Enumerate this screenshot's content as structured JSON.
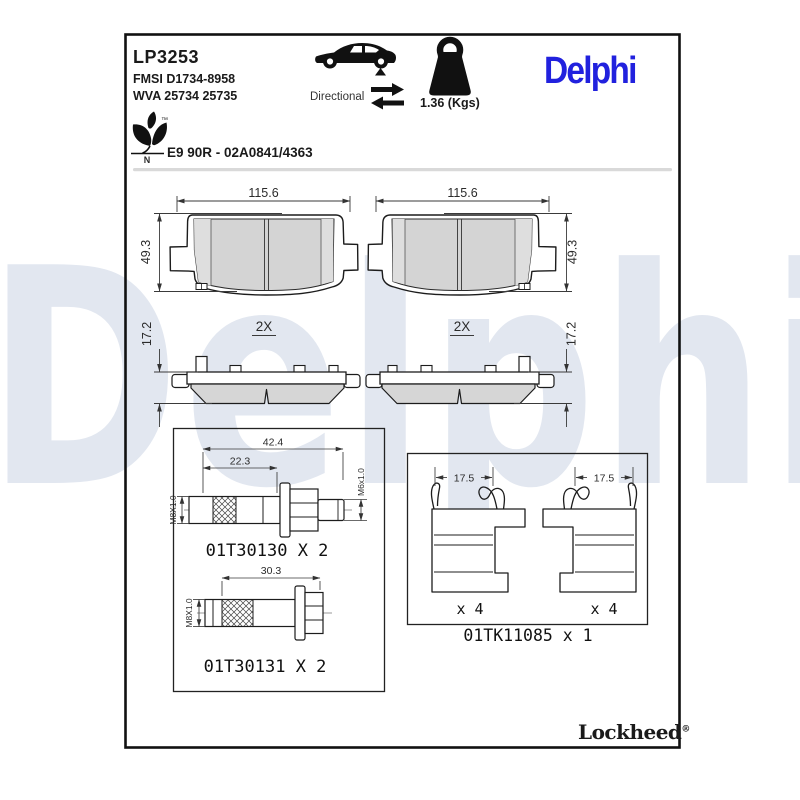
{
  "header": {
    "product_code": "LP3253",
    "fmsi": "FMSI D1734-8958",
    "wva": "WVA 25734 25735",
    "directional_label": "Directional",
    "weight": "1.36 (Kgs)",
    "brand": "Delphi",
    "eco_mark": "N",
    "eco_tm": "™",
    "approval": "E9 90R - 02A0841/4363"
  },
  "watermark": {
    "text": "Delphi"
  },
  "pads": {
    "width_dim": "115.6",
    "height_dim": "49.3",
    "side_height_dim": "17.2",
    "side_qty": "2X"
  },
  "hardware": {
    "bolt1": {
      "len_total": "42.4",
      "len_partial": "22.3",
      "thread_main": "M8X1.0",
      "thread_tip": "M6x1.0",
      "part": "01T30130 X 2"
    },
    "bolt2": {
      "len_total": "30.3",
      "thread_main": "M8X1.0",
      "part": "01T30131 X 2"
    }
  },
  "clips": {
    "width_dim": "17.5",
    "qty_each": "x 4",
    "part": "01TK11085 x 1"
  },
  "footer": {
    "brand": "Lockheed",
    "reg": "®"
  },
  "colors": {
    "delphi_blue": "#2121DE",
    "watermark": "#e2e7f0",
    "friction_gray": "#d4d4d4",
    "line": "#1c1c1c"
  }
}
